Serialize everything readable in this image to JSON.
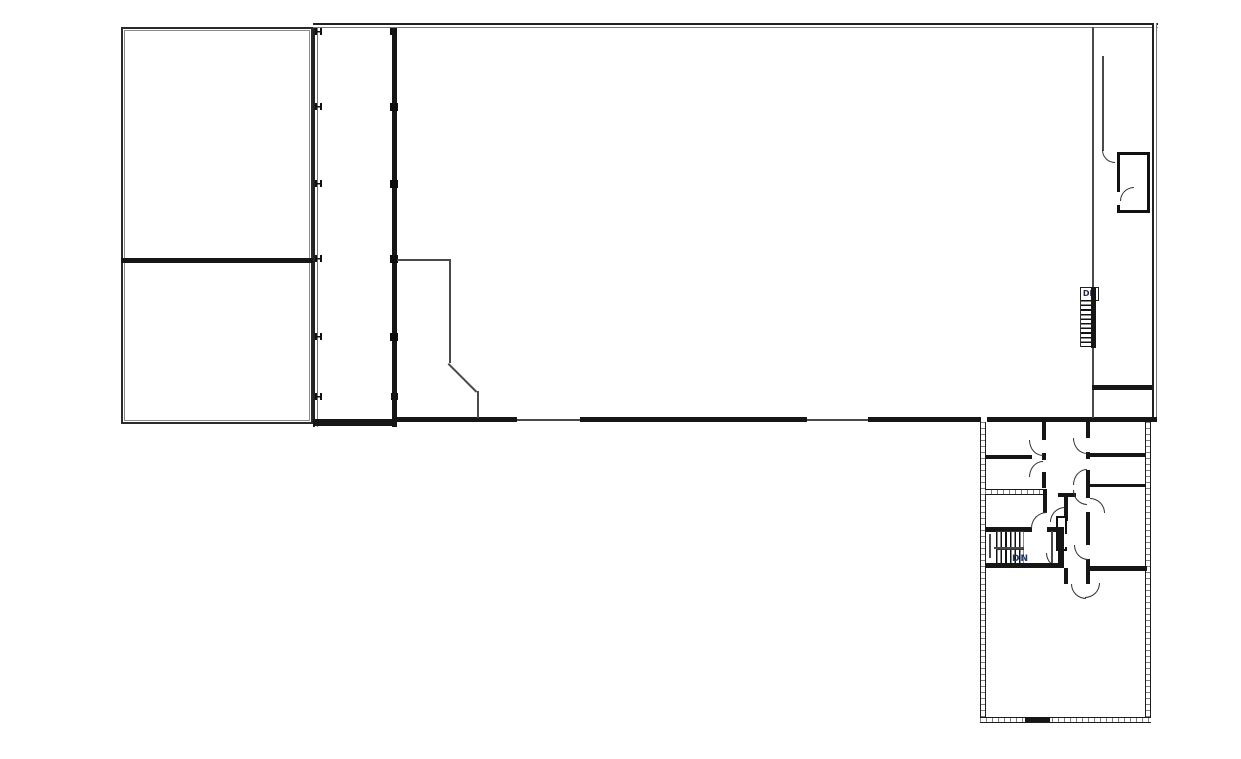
{
  "title": "architectural-floor-plan",
  "labels": {
    "stair_upper_dn": "DN",
    "stair_lower_dn": "DN"
  },
  "colors": {
    "background": "#ffffff",
    "wall_black": "#161616",
    "wall_gray": "#777777",
    "thin_line": "#4a4a4a",
    "door_arc": "#333333",
    "dn_upper_text": "#26264a",
    "dn_lower_text": "#1f3864"
  }
}
